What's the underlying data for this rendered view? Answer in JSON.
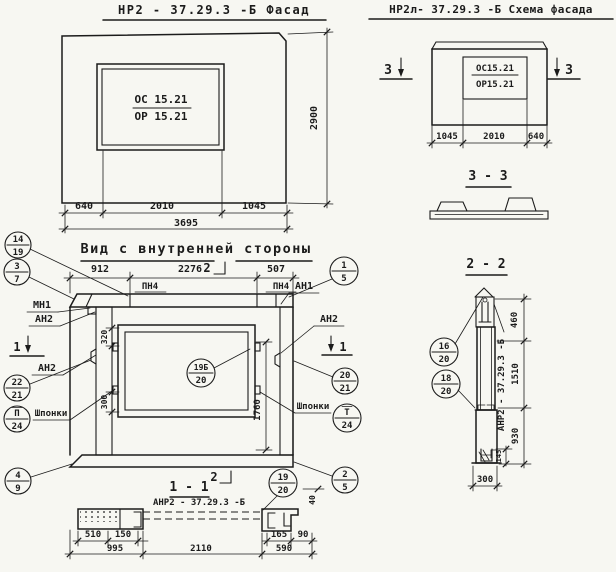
{
  "facade": {
    "title": "НР2 - 37.29.3 -Б   Фасад",
    "mark_top": "ОС 15.21",
    "mark_bottom": "ОР 15.21",
    "dim_640": "640",
    "dim_2010": "2010",
    "dim_1045": "1045",
    "dim_3695": "3695",
    "dim_2900": "2900"
  },
  "schema": {
    "title": "НР2л- 37.29.3  -Б  Схема фасада",
    "mark_top": "ОС15.21",
    "mark_bottom": "ОР15.21",
    "dim_1045": "1045",
    "dim_2010": "2010",
    "dim_640": "640",
    "sec3": "3",
    "section_title": "3 - 3"
  },
  "inner": {
    "title": "Вид с внутренней стороны",
    "dim_912": "912",
    "dim_2276": "2276",
    "dim_507": "507",
    "pn4": "ПН4",
    "mn1": "МН1",
    "an1": "АН1",
    "an2": "АН2",
    "shponki": "Шпонки",
    "dim_320": "320",
    "dim_300": "300",
    "dim_1760": "1760",
    "sec1": "1",
    "sec2": "2"
  },
  "sec11": {
    "title": "1 - 1",
    "label": "АНР2 - 37.29.3  -Б",
    "dim_510": "510",
    "dim_150": "150",
    "dim_995": "995",
    "dim_2110": "2110",
    "dim_165": "165",
    "dim_90": "90",
    "dim_590": "590",
    "dim_40": "40"
  },
  "sec22": {
    "title": "2 - 2",
    "label": "АНР2 - 37.29.3 -Б",
    "dim_460": "460",
    "dim_1510": "1510",
    "dim_930": "930",
    "dim_145": "145",
    "dim_300": "300"
  },
  "callouts": {
    "c14_19": {
      "top": "14",
      "bot": "19"
    },
    "c3_7": {
      "top": "3",
      "bot": "7"
    },
    "c1_5": {
      "top": "1",
      "bot": "5"
    },
    "c22_21": {
      "top": "22",
      "bot": "21"
    },
    "cp_24": {
      "top": "П",
      "bot": "24"
    },
    "c4_9": {
      "top": "4",
      "bot": "9"
    },
    "c19b_20": {
      "top": "19Б",
      "bot": "20"
    },
    "c20_21": {
      "top": "20",
      "bot": "21"
    },
    "ct_24": {
      "top": "Т",
      "bot": "24"
    },
    "c2_5": {
      "top": "2",
      "bot": "5"
    },
    "c19_20": {
      "top": "19",
      "bot": "20"
    },
    "c16_20": {
      "top": "16",
      "bot": "20"
    },
    "c18_20": {
      "top": "18",
      "bot": "20"
    }
  }
}
